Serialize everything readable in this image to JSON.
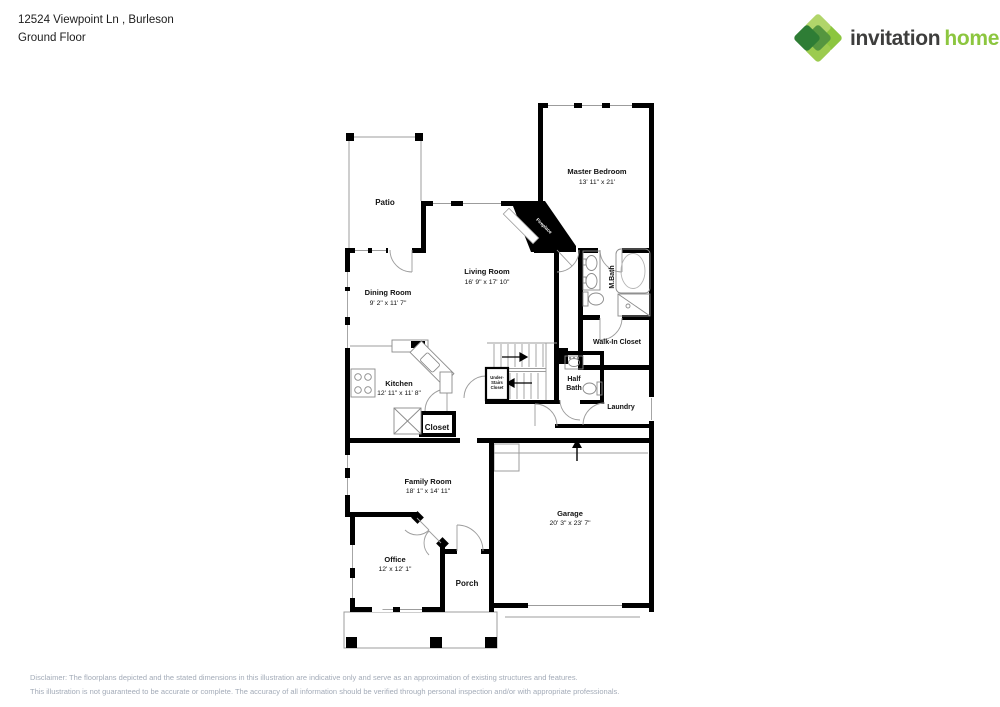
{
  "header": {
    "address": "12524 Viewpoint Ln , Burleson",
    "floor_label": "Ground Floor"
  },
  "logo": {
    "brand_word1": "invitation",
    "brand_word2": "homes",
    "trademark": "™"
  },
  "colors": {
    "brand_green": "#8cc63f",
    "brand_dark_green": "#2e7d35",
    "brand_text_dark": "#3e3e3d",
    "wall": "#000000",
    "thin_line": "#9c9c9c",
    "disclaimer_text": "#a3abb8"
  },
  "plan": {
    "labels": {
      "patio": "Patio",
      "master_bedroom": {
        "name": "Master Bedroom",
        "dims": "13' 11\" x 21'"
      },
      "living_room": {
        "name": "Living Room",
        "dims": "16' 9\" x 17' 10\""
      },
      "dining_room": {
        "name": "Dining Room",
        "dims": "9' 2\" x 11' 7\""
      },
      "kitchen": {
        "name": "Kitchen",
        "dims": "12' 11\" x 11' 8\""
      },
      "family_room": {
        "name": "Family Room",
        "dims": "18' 1\" x 14' 11\""
      },
      "office": {
        "name": "Office",
        "dims": "12' x 12' 1\""
      },
      "garage": {
        "name": "Garage",
        "dims": "20' 3\" x 23' 7\""
      },
      "master_bath": "M.Bath",
      "walk_in_closet": "Walk-In Closet",
      "half_bath_line1": "Half",
      "half_bath_line2": "Bath",
      "laundry": "Laundry",
      "closet": "Closet",
      "under_stairs_line1": "Under-",
      "under_stairs_line2": "Stairs",
      "under_stairs_line3": "Closet",
      "fireplace": "Fireplace",
      "porch": "Porch"
    }
  },
  "disclaimer": {
    "line1": "Disclaimer: The floorplans depicted and the stated dimensions in this illustration are indicative only and serve as an approximation of existing structures and features.",
    "line2": "This illustration is not guaranteed to be accurate or complete. The accuracy of all information should be verified through personal inspection and/or with appropriate professionals."
  }
}
